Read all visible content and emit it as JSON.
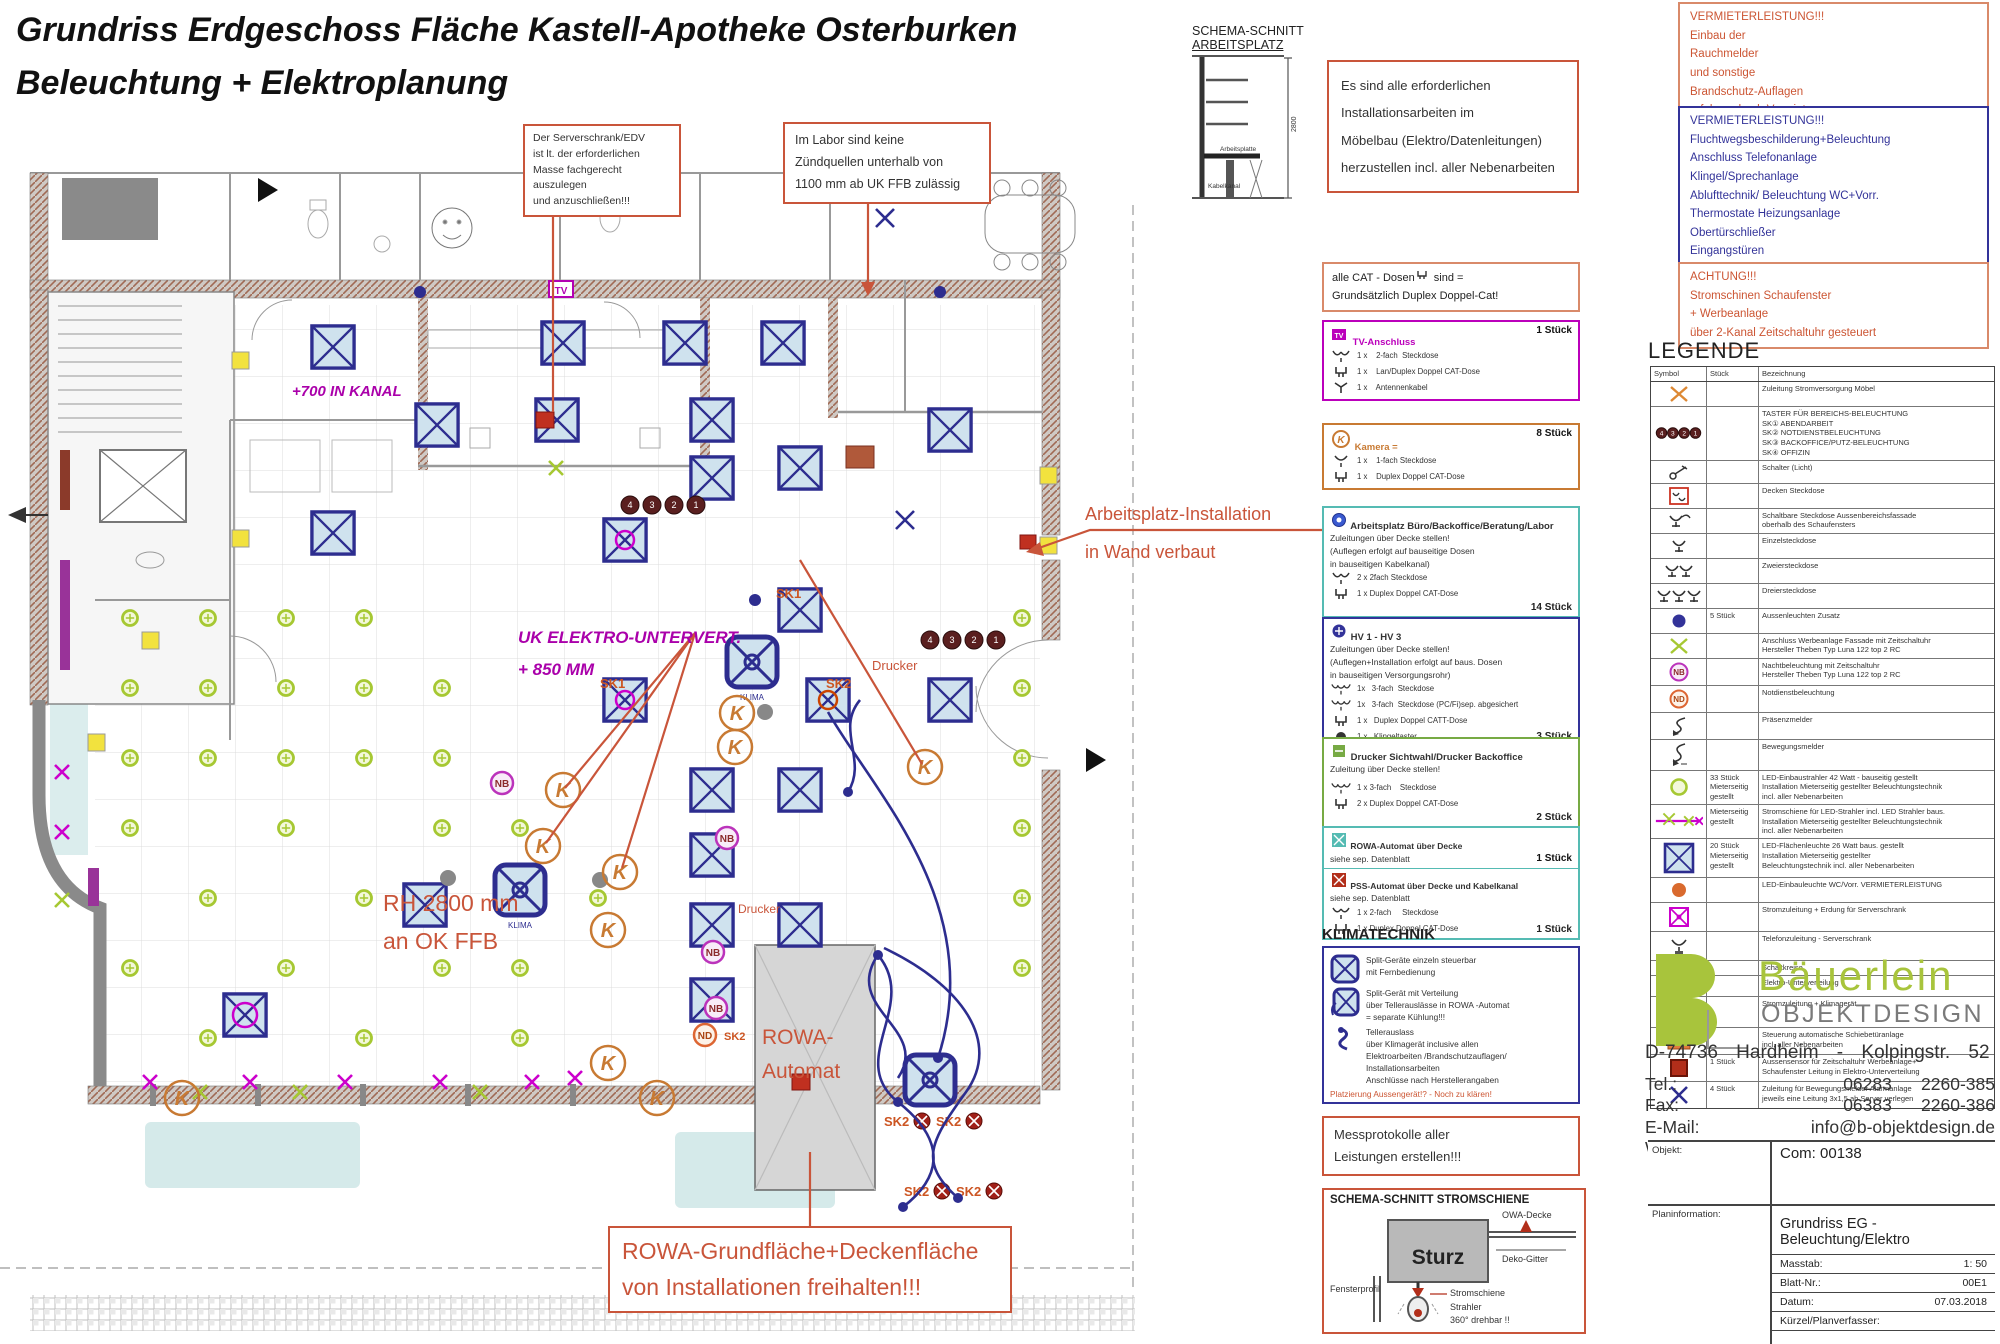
{
  "title": {
    "line1": "Grundriss Erdgeschoss Fläche Kastell-Apotheke Osterburken",
    "line2": "Beleuchtung + Elektroplanung"
  },
  "notes": {
    "server": {
      "lines": [
        "Der Serverschrank/EDV",
        "ist lt. der erforderlichen",
        "Masse fachgerecht auszulegen",
        "und anzuschließen!!!"
      ]
    },
    "labor": {
      "lines": [
        "Im Labor sind keine",
        "Zündquellen unterhalb von",
        "1100 mm ab UK FFB zulässig"
      ]
    },
    "install": {
      "lines": [
        "Es sind alle erforderlichen",
        "Installationsarbeiten im",
        "Möbelbau (Elektro/Datenleitungen)",
        "herzustellen incl. aller Nebenarbeiten"
      ]
    },
    "vermieter1": {
      "title": "VERMIETERLEISTUNG!!!",
      "lines": [
        "Einbau der",
        "Rauchmelder",
        "und sonstige",
        "Brandschutz-Auflagen",
        "erfolgen durch Vermieter"
      ]
    },
    "vermieter2": {
      "title": "VERMIETERLEISTUNG!!!",
      "lines": [
        "Fluchtwegsbeschilderung+Beleuchtung",
        "Anschluss Telefonanlage",
        "Klingel/Sprechanlage",
        "Ablufttechnik/ Beleuchtung WC+Vorr.",
        "Thermostate Heizungsanlage",
        "Obertürschließer",
        "Eingangstüren"
      ]
    },
    "achtung": {
      "title": "ACHTUNG!!!",
      "lines": [
        "Stromschinen Schaufenster",
        "+ Werbeanlage",
        "über 2-Kanal Zeitschaltuhr gesteuert"
      ]
    },
    "cat": {
      "line1_pre": "alle CAT - Dosen",
      "line1_post": " sind =",
      "line2": "Grundsätzlich Duplex Doppel-Cat!"
    },
    "mess": {
      "lines": [
        "Messprotokolle aller",
        "Leistungen erstellen!!!"
      ]
    },
    "rowa_keep": {
      "lines": [
        "ROWA-Grundfläche+Deckenfläche",
        "von Installationen freihalten!!!"
      ]
    }
  },
  "schema_arbeitsplatz": {
    "title1": "SCHEMA-SCHNITT",
    "title2": "ARBEITSPLATZ",
    "label_arbeitsplatte": "Arbeitsplatte",
    "label_kabelkanal": "Kabelkanal",
    "dim": "2800"
  },
  "spec_boxes": {
    "tv": {
      "accent": "#bb00bb",
      "icon": "tv-anschluss-icon",
      "title": "TV-Anschluss",
      "count": "1 Stück",
      "items": [
        {
          "icon": "steckdose-2fach-icon",
          "text": "1 x    2-fach  Steckdose"
        },
        {
          "icon": "cat-dose-icon",
          "text": "1 x    Lan/Duplex Doppel CAT-Dose"
        },
        {
          "icon": "antennen-icon",
          "text": "1 x    Antennenkabel"
        }
      ]
    },
    "kamera": {
      "accent": "#c87a33",
      "icon": "kamera-icon",
      "title": "Kamera =",
      "count": "8 Stück",
      "items": [
        {
          "icon": "steckdose-1fach-icon",
          "text": "1 x    1-fach Steckdose"
        },
        {
          "icon": "cat-dose-icon",
          "text": "1 x    Duplex Doppel CAT-Dose"
        }
      ]
    },
    "arbeitsplatz": {
      "accent": "#55bbb3",
      "icon": "arbeitsplatz-icon",
      "title": "Arbeitsplatz Büro/Backoffice/Beratung/Labor",
      "lines": [
        "Zuleitungen über Decke stellen!",
        "(Auflegen erfolgt auf bauseitige Dosen",
        "in bauseitigen Kabelkanal)"
      ],
      "count": "14 Stück",
      "items": [
        {
          "icon": "steckdose-2fach-icon",
          "text": "2 x 2fach Steckdose"
        },
        {
          "icon": "cat-dose-icon",
          "text": "1 x Duplex Doppel CAT-Dose"
        }
      ]
    },
    "hv": {
      "accent": "#333399",
      "icon": "hv-icon",
      "title": "HV 1 - HV 3",
      "lines": [
        "Zuleitungen über Decke stellen!",
        "(Auflegen+Installation erfolgt auf baus. Dosen",
        "in bauseitigen Versorgungsrohr)"
      ],
      "count": "3 Stück",
      "items": [
        {
          "icon": "steckdose-3fach-icon",
          "text": "1x   3-fach  Steckdose"
        },
        {
          "icon": "steckdose-3fach-icon",
          "text": "1x   3-fach  Steckdose (PC/Fi)sep. abgesichert"
        },
        {
          "icon": "cat-dose-icon",
          "text": "1 x   Duplex Doppel CATT-Dose"
        },
        {
          "icon": "klingel-icon",
          "text": "1 x   Klingeltaster"
        }
      ]
    },
    "drucker": {
      "accent": "#77aa44",
      "icon": "drucker-icon",
      "title": "Drucker Sichtwahl/Drucker Backoffice",
      "lines": [
        "Zuleitung über Decke stellen!"
      ],
      "count": "2 Stück",
      "items": [
        {
          "icon": "steckdose-3fach-icon",
          "text": "1 x 3-fach    Steckdose"
        },
        {
          "icon": "cat-dose-icon",
          "text": "2 x Duplex Doppel CAT-Dose"
        }
      ]
    },
    "rowa": {
      "accent": "#55bbb3",
      "s1_title": "ROWA-Automat über Decke",
      "s1_line": "siehe sep. Datenblatt",
      "s1_count": "1 Stück",
      "s2_title": "PSS-Automat über Decke und Kabelkanal",
      "s2_line": "siehe sep. Datenblatt",
      "s2_count": "1 Stück",
      "items": [
        {
          "icon": "steckdose-2fach-icon",
          "text": "1 x 2-fach     Steckdose"
        },
        {
          "icon": "cat-dose-icon",
          "text": "1 x Duplex Doppel CAT-Dose"
        }
      ]
    }
  },
  "klimatechnik": {
    "heading": "KLIMATECHNIK",
    "note": "Platzierung Aussengerät!? - Noch zu klären!",
    "entries": [
      {
        "icon": "split-unit-icon",
        "text": "Split-Geräte einzeln steuerbar\nmit Fernbedienung"
      },
      {
        "icon": "split-dist-icon",
        "text": "Split-Gerät mit Verteilung\nüber Tellerauslässe in ROWA -Automat\n= separate Kühlung!!!"
      },
      {
        "icon": "teller-hose-icon",
        "text": "Tellerauslass\nüber Klimagerät inclusive allen\nElektroarbeiten /Brandschutzauflagen/\nInstallationsarbeiten\nAnschlüsse nach Herstellerangaben"
      }
    ]
  },
  "strom_schema": {
    "title": "SCHEMA-SCHNITT STROMSCHIENE",
    "labels": {
      "owa": "OWA-Decke",
      "deko": "Deko-Gitter",
      "sturz": "Sturz",
      "fenster": "Fensterprofil",
      "schiene": "Stromschiene",
      "strahler": "Strahler",
      "drehbar": "360° drehbar !!"
    }
  },
  "legend": {
    "title": "LEGENDE",
    "headers": [
      "Symbol",
      "Stück",
      "Bezeichnung"
    ],
    "rows": [
      {
        "icon": "moebel-zuleitung-x-icon",
        "stueck": "",
        "desc": "Zuleitung Stromversorgung Möbel"
      },
      {
        "icon": "taster-gruppe-icon",
        "stueck": "",
        "desc": "TASTER FÜR BEREICHS-BELEUCHTUNG\nSK① ABENDARBEIT\nSK② NOTDIENSTBELEUCHTUNG\nSK③ BACKOFFICE/PUTZ-BELEUCHTUNG\nSK④ OFFIZIN"
      },
      {
        "icon": "schalter-icon",
        "stueck": "",
        "desc": "Schalter (Licht)"
      },
      {
        "icon": "decken-steckdose-icon",
        "stueck": "",
        "desc": "Decken Steckdose"
      },
      {
        "icon": "schaltbare-steckdose-icon",
        "stueck": "",
        "desc": "Schaltbare Steckdose Aussenbereichsfassade\noberhalb des Schaufensters"
      },
      {
        "icon": "einzelsteckdose-icon",
        "stueck": "",
        "desc": "Einzelsteckdose"
      },
      {
        "icon": "zweiersteckdose-icon",
        "stueck": "",
        "desc": "Zweiersteckdose"
      },
      {
        "icon": "dreiersteckdose-icon",
        "stueck": "",
        "desc": "Dreiersteckdose"
      },
      {
        "icon": "aussenleuchte-icon",
        "stueck": "5 Stück",
        "desc": "Aussenleuchten Zusatz"
      },
      {
        "icon": "werbeanlage-x-icon",
        "stueck": "",
        "desc": "Anschluss Werbeanlage Fassade mit Zeitschaltuhr\nHersteller Theben Typ Luna 122 top 2 RC"
      },
      {
        "icon": "nachtbeleuchtung-icon",
        "stueck": "",
        "desc": "Nachtbeleuchtung mit Zeitschaltuhr\nHersteller Theben Typ Luna 122 top 2 RC"
      },
      {
        "icon": "notdienst-icon",
        "stueck": "",
        "desc": "Notdienstbeleuchtung"
      },
      {
        "icon": "praesenzmelder-icon",
        "stueck": "",
        "desc": "Präsenzmelder"
      },
      {
        "icon": "bewegungsmelder-icon",
        "stueck": "",
        "desc": "Bewegungsmelder"
      },
      {
        "icon": "led-einbaustrahler-icon",
        "stueck": "33 Stück\nMieterseitig\ngestellt",
        "desc": "LED-Einbaustrahler 42 Watt - bauseitig gestellt\nInstallation Mieterseitig gestellter Beleuchtungstechnik\nincl. aller Nebenarbeiten"
      },
      {
        "icon": "stromschiene-icon",
        "stueck": "Mieterseitig\ngestellt",
        "desc": "Stromschiene für LED-Strahler incl. LED Strahler baus.\nInstallation Mieterseitig gestellter Beleuchtungstechnik\nincl. aller Nebenarbeiten"
      },
      {
        "icon": "led-flaechenleuchte-icon",
        "stueck": "20 Stück\nMieterseitig\ngestellt",
        "desc": "LED-Flächenleuchte 26 Watt baus. gestellt\nInstallation Mieterseitig gestellter\nBeleuchtungstechnik incl. aller Nebenarbeiten"
      },
      {
        "icon": "led-einbauleuchte-wc-icon",
        "stueck": "",
        "desc": "LED-Einbauleuchte WC/Vorr. VERMIETERLEISTUNG"
      },
      {
        "icon": "server-strom-icon",
        "stueck": "",
        "desc": "Stromzuleitung + Erdung für Serverschrank"
      },
      {
        "icon": "telefon-server-icon",
        "stueck": "",
        "desc": "Telefonzuleitung - Serverschrank"
      },
      {
        "icon": "schaltkreise-label",
        "symbol_text": "SK1- 4",
        "stueck": "",
        "desc": "Schaltkreise"
      },
      {
        "icon": "unterverteilung-icon",
        "stueck": "",
        "desc": "Elektro-Unterverteilung"
      },
      {
        "icon": "klima-strom-icon",
        "stueck": "",
        "desc": "Stromzuleitung + Klimagerät"
      },
      {
        "icon": "schiebetuer-icon",
        "stueck": "",
        "desc": "Steuerung automatische Schiebetüranlage\nincl. aller Nebenarbeiten"
      },
      {
        "icon": "aussensensor-icon",
        "stueck": "1 Stück",
        "desc": "Aussensensor für Zeitschaltuhr Werbeanlage+\nSchaufenster Leitung in Elektro-Unterverteilung"
      },
      {
        "icon": "alarm-zuleitung-x-icon",
        "stueck": "4 Stück",
        "desc": "Zuleitung für Bewegungsmelder Alarmanlage\njeweils eine Leitung 3x1,5 ab Server verlegen"
      }
    ]
  },
  "brand": {
    "name": "Bäuerlein",
    "sub": "OBJEKTDESIGN",
    "green": "#a8c43c",
    "address": "D-74736 Hardheim - Kolpingstr. 52",
    "contacts": [
      {
        "label": "Tel.:",
        "value": "06283      2260-385"
      },
      {
        "label": "Fax:",
        "value": "06383      2260-386"
      },
      {
        "label": "E-Mail:",
        "value": "info@b-objektdesign.de"
      },
      {
        "label": "Web:",
        "value": "www.b-objektdesign.de"
      }
    ]
  },
  "titleblock": {
    "objekt_label": "Objekt:",
    "objekt_value": "Com: 00138",
    "plan_label": "Planinformation:",
    "plan_value": "Grundriss EG - Beleuchtung/Elektro",
    "rows": [
      {
        "label": "Masstab:",
        "value": "1: 50"
      },
      {
        "label": "Blatt-Nr.:",
        "value": "00E1"
      },
      {
        "label": "Datum:",
        "value": "07.03.2018"
      },
      {
        "label": "Kürzel/Planverfasser:",
        "value": ""
      }
    ]
  },
  "plan": {
    "labels": {
      "kanal": "+700 IN KANAL",
      "uk1": "UK ELEKTRO-UNTERVERT.",
      "uk2": "+ 850 MM",
      "rh1": "RH 2800 mm",
      "rh2": "an OK FFB",
      "rowa1": "ROWA-",
      "rowa2": "Automat",
      "drucker": "Drucker",
      "arb1": "Arbeitsplatz-Installation",
      "arb2": "in Wand verbaut"
    },
    "symbols": {
      "k": "K",
      "nb": "NB",
      "nd": "ND",
      "tv": "TV",
      "sk1": "SK1",
      "sk2": "SK2",
      "klima": "KLIMA",
      "taster": [
        "4",
        "3",
        "2",
        "1"
      ]
    }
  }
}
